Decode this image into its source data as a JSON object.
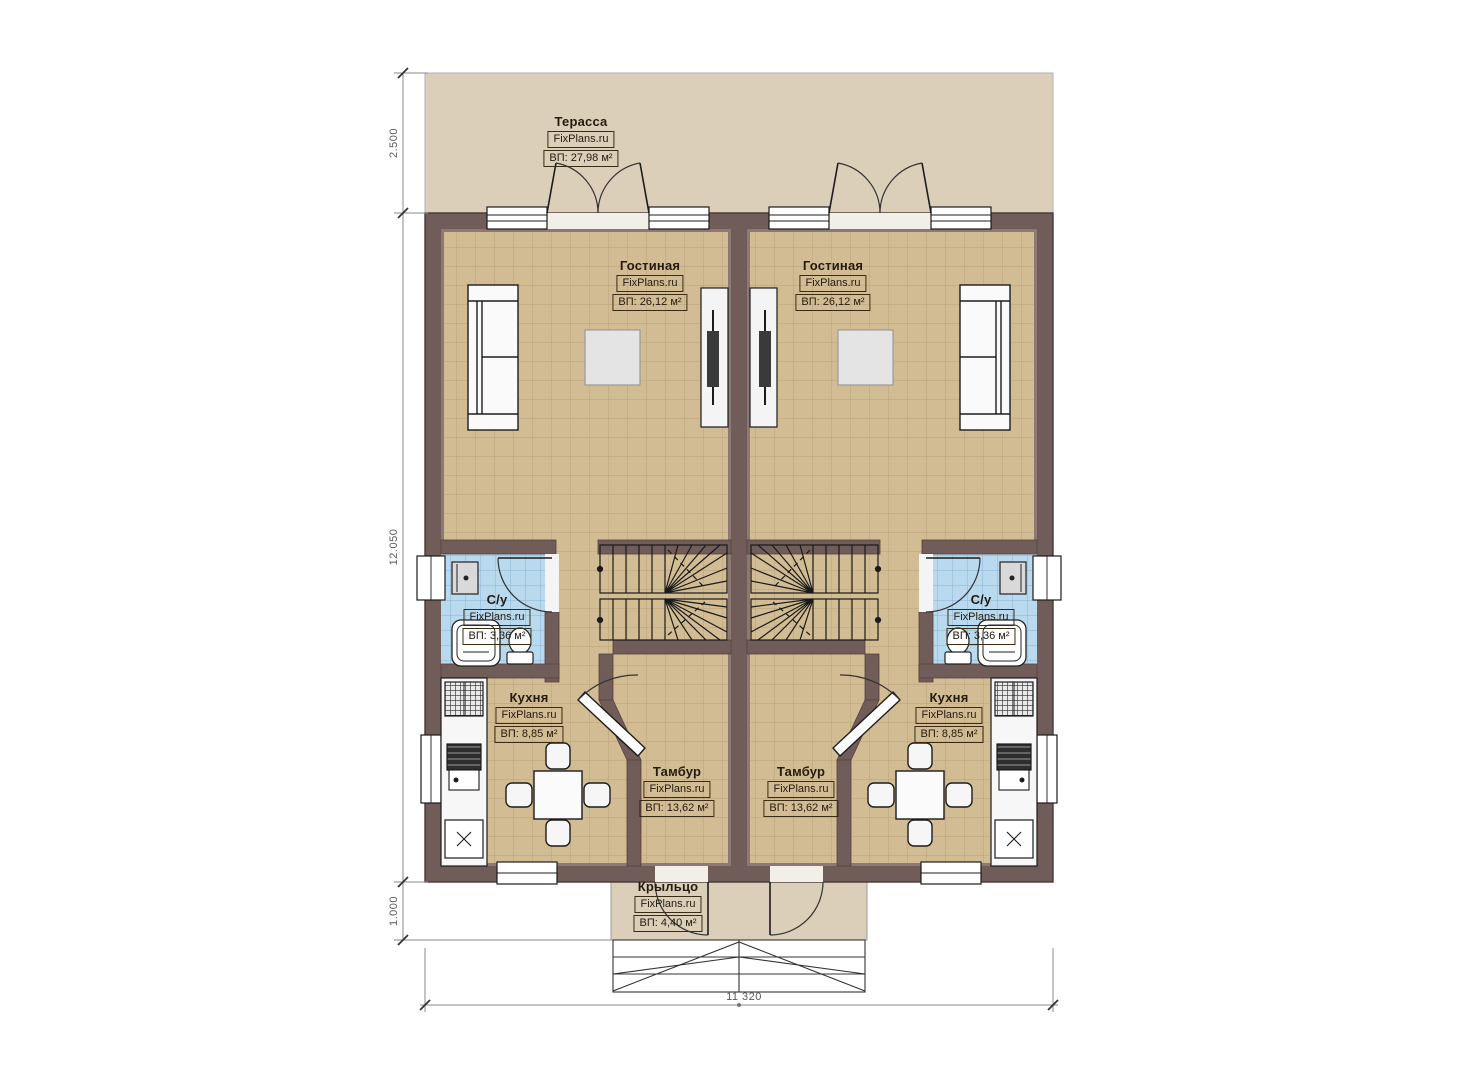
{
  "watermark": "FixPlans.ru",
  "rooms": {
    "terrace": {
      "name": "Терасса",
      "area": "ВП: 27,98 м²"
    },
    "living_left": {
      "name": "Гостиная",
      "area": "ВП: 26,12 м²"
    },
    "living_right": {
      "name": "Гостиная",
      "area": "ВП: 26,12 м²"
    },
    "wc_left": {
      "name": "С/у",
      "area": "ВП: 3,36 м²"
    },
    "wc_right": {
      "name": "С/у",
      "area": "ВП: 3,36 м²"
    },
    "kitchen_left": {
      "name": "Кухня",
      "area": "ВП: 8,85 м²"
    },
    "kitchen_right": {
      "name": "Кухня",
      "area": "ВП: 8,85 м²"
    },
    "vestibule_left": {
      "name": "Тамбур",
      "area": "ВП: 13,62 м²"
    },
    "vestibule_right": {
      "name": "Тамбур",
      "area": "ВП: 13,62 м²"
    },
    "porch": {
      "name": "Крыльцо",
      "area": "ВП: 4,40 м²"
    }
  },
  "dimensions": {
    "terrace_depth": "2.500",
    "house_depth": "12.050",
    "porch_depth": "1.000",
    "house_width": "11 320"
  },
  "colors": {
    "wall": "#705c58",
    "wall_outline": "#4a3835",
    "floor": "#d2bc93",
    "floor_grid": "#b9a17a",
    "terrace_fill": "#dbcfba",
    "bathroom_tile": "#b9d9ee",
    "bathroom_grid": "#8db4d2",
    "furniture": "#fafafa",
    "outline": "#1c1c1c"
  }
}
